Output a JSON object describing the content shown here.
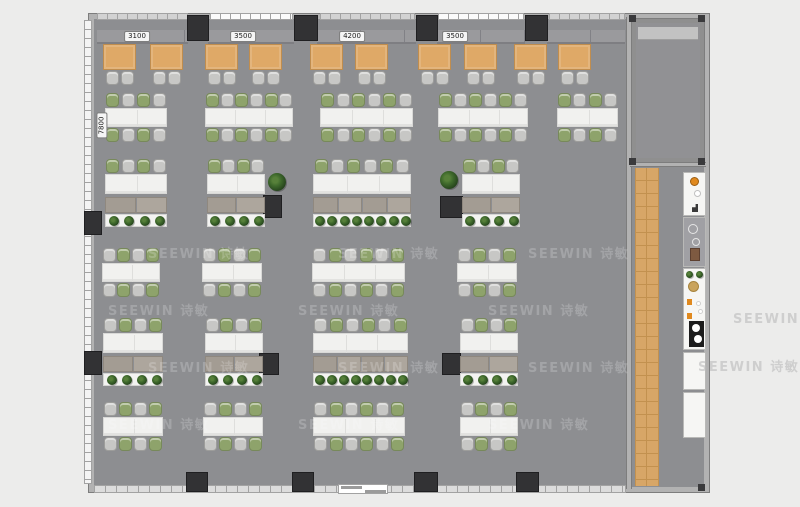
{
  "meta": {
    "title": "office-floor-plan",
    "canvas": {
      "width": 800,
      "height": 507
    }
  },
  "watermark": {
    "text": "SEEWIN 诗敏",
    "floor_color": "rgba(255,255,255,0.20)",
    "outer_color": "rgba(186,186,186,0.60)",
    "floor_rows": [
      {
        "y": 243,
        "xs": [
          148,
          338,
          528
        ]
      },
      {
        "y": 300,
        "xs": [
          108,
          298,
          488
        ]
      },
      {
        "y": 357,
        "xs": [
          148,
          338,
          528
        ]
      },
      {
        "y": 414,
        "xs": [
          108,
          298,
          488
        ]
      }
    ],
    "outer": [
      {
        "x": 733,
        "y": 308
      },
      {
        "x": 698,
        "y": 356
      }
    ]
  },
  "dimensions": {
    "top": [
      {
        "label": "3100",
        "x": 137,
        "y": 31
      },
      {
        "label": "3500",
        "x": 243,
        "y": 31
      },
      {
        "label": "4200",
        "x": 352,
        "y": 31
      },
      {
        "label": "3500",
        "x": 455,
        "y": 31
      }
    ],
    "left": [
      {
        "label": "7800",
        "x": 101,
        "y": 120
      }
    ]
  },
  "palette": {
    "outer_bg": "#ececeb",
    "floor": "#8d8e91",
    "wall": "#b2b2b2",
    "wall_edge": "#7d7d7d",
    "column": "#323234",
    "window": "#f4f4f4",
    "window_tick": "#a2a2a2",
    "bench": "#9a9a9d",
    "bench_line": "#818186",
    "cafe_table": "#dfa967",
    "cafe_table_edge": "#c08d4e",
    "chair_gray": "#c7c7c5",
    "chair_green": "#8ea36b",
    "chair_edge": "#9d9d9b",
    "table_white": "#f1f1ef",
    "table_edge": "#d9d9d7",
    "desk_a": "#a39c93",
    "desk_b": "#ada69d",
    "planter_box": "#f3f3f1",
    "plant_dark": "#24411c",
    "plant_mid": "#3f6a2c",
    "plant_light": "#57803a",
    "wood": "#d7a667",
    "wood_line": "#c2914f",
    "room_floor": "#919194",
    "room_band": "#c2c2c2",
    "pantry_white": "#f6f6f4",
    "pantry_gray": "#a0a0a4",
    "fixture_orange": "#e0891e",
    "fixture_tan": "#c9a35c",
    "cooktop": "#1c1c1c"
  },
  "building": {
    "x": 88,
    "y": 13,
    "w": 622,
    "h": 480,
    "divider_wall_x": 626,
    "room": {
      "x": 632,
      "y": 19,
      "w": 72,
      "h": 143
    },
    "corridor": {
      "x": 632,
      "y": 166,
      "w": 72,
      "h": 321
    },
    "wood_strip": {
      "x": 635,
      "y": 168,
      "w": 24,
      "h": 318
    }
  },
  "windows": {
    "left": {
      "x": 84,
      "y": 20,
      "w": 8,
      "h": 464
    },
    "top_segments": [
      {
        "x": 97,
        "w": 91,
        "bright": false
      },
      {
        "x": 210,
        "w": 83,
        "bright": true
      },
      {
        "x": 320,
        "w": 95,
        "bright": false
      },
      {
        "x": 438,
        "w": 86,
        "bright": true
      },
      {
        "x": 549,
        "w": 76,
        "bright": false
      }
    ],
    "bottom": {
      "x": 94,
      "y": 485,
      "w": 532,
      "h": 8
    },
    "door": {
      "x": 338,
      "y": 484,
      "w": 50
    }
  },
  "bench_segments": [
    {
      "x": 97,
      "w": 91
    },
    {
      "x": 208,
      "w": 86
    },
    {
      "x": 317,
      "w": 99
    },
    {
      "x": 437,
      "w": 88
    },
    {
      "x": 547,
      "w": 78
    }
  ],
  "columns": [
    {
      "x": 188,
      "y": 16,
      "w": 20,
      "h": 24
    },
    {
      "x": 295,
      "y": 16,
      "w": 22,
      "h": 24
    },
    {
      "x": 417,
      "y": 16,
      "w": 20,
      "h": 24
    },
    {
      "x": 526,
      "y": 16,
      "w": 21,
      "h": 24
    },
    {
      "x": 85,
      "y": 212,
      "w": 16,
      "h": 22
    },
    {
      "x": 85,
      "y": 352,
      "w": 16,
      "h": 22
    },
    {
      "x": 264,
      "y": 196,
      "w": 17,
      "h": 21
    },
    {
      "x": 441,
      "y": 197,
      "w": 21,
      "h": 20
    },
    {
      "x": 260,
      "y": 354,
      "w": 18,
      "h": 20
    },
    {
      "x": 443,
      "y": 354,
      "w": 17,
      "h": 20
    },
    {
      "x": 187,
      "y": 473,
      "w": 20,
      "h": 18
    },
    {
      "x": 293,
      "y": 473,
      "w": 20,
      "h": 18
    },
    {
      "x": 415,
      "y": 473,
      "w": 22,
      "h": 18
    },
    {
      "x": 517,
      "y": 473,
      "w": 21,
      "h": 18
    }
  ],
  "corner_dots": [
    {
      "x": 629,
      "y": 15
    },
    {
      "x": 698,
      "y": 15
    },
    {
      "x": 629,
      "y": 158
    },
    {
      "x": 698,
      "y": 158
    },
    {
      "x": 698,
      "y": 484
    }
  ],
  "cafe": {
    "table_y": 44,
    "table_w": 33,
    "table_h": 26,
    "chair_y": 71,
    "tables_x": [
      103,
      150,
      205,
      249,
      310,
      355,
      418,
      464,
      514,
      558
    ]
  },
  "meeting_rows": [
    {
      "name": "row-b",
      "table_y": 108,
      "start": "green",
      "clusters": [
        {
          "x": 105,
          "w": 62,
          "seats": 4
        },
        {
          "x": 205,
          "w": 88,
          "seats": 6
        },
        {
          "x": 320,
          "w": 93,
          "seats": 6
        },
        {
          "x": 438,
          "w": 90,
          "seats": 6
        },
        {
          "x": 557,
          "w": 61,
          "seats": 4
        }
      ]
    },
    {
      "name": "row-d",
      "table_y": 263,
      "start": "gray",
      "clusters": [
        {
          "x": 102,
          "w": 58,
          "seats": 4
        },
        {
          "x": 202,
          "w": 60,
          "seats": 4
        },
        {
          "x": 312,
          "w": 93,
          "seats": 6
        },
        {
          "x": 457,
          "w": 60,
          "seats": 4
        }
      ]
    },
    {
      "name": "row-f",
      "table_y": 417,
      "start": "gray",
      "clusters": [
        {
          "x": 103,
          "w": 60,
          "seats": 4
        },
        {
          "x": 203,
          "w": 60,
          "seats": 4
        },
        {
          "x": 313,
          "w": 92,
          "seats": 6
        },
        {
          "x": 460,
          "w": 58,
          "seats": 4
        }
      ]
    }
  ],
  "workstation_rows": [
    {
      "name": "row-c",
      "chair_y": 159,
      "start": "green",
      "clusters": [
        {
          "x": 105,
          "w": 62,
          "seats": 4
        },
        {
          "x": 207,
          "w": 58,
          "seats": 4
        },
        {
          "x": 313,
          "w": 98,
          "seats": 6
        },
        {
          "x": 462,
          "w": 58,
          "seats": 4
        }
      ],
      "plants": [
        {
          "x": 268,
          "y": 173
        },
        {
          "x": 440,
          "y": 171
        }
      ]
    },
    {
      "name": "row-e",
      "chair_y": 318,
      "start": "gray",
      "clusters": [
        {
          "x": 103,
          "w": 60,
          "seats": 4
        },
        {
          "x": 205,
          "w": 58,
          "seats": 4
        },
        {
          "x": 313,
          "w": 95,
          "seats": 6
        },
        {
          "x": 460,
          "w": 58,
          "seats": 4
        }
      ],
      "plants": []
    }
  ],
  "pantry": {
    "x": 683,
    "w": 23,
    "units": [
      {
        "y": 172,
        "h": 44,
        "type": "sink-unit"
      },
      {
        "y": 217,
        "h": 50,
        "type": "equipment-gray"
      },
      {
        "y": 268,
        "h": 82,
        "type": "cooktop-unit"
      },
      {
        "y": 352,
        "h": 38,
        "type": "cabinet"
      },
      {
        "y": 392,
        "h": 46,
        "type": "cabinet"
      }
    ]
  }
}
